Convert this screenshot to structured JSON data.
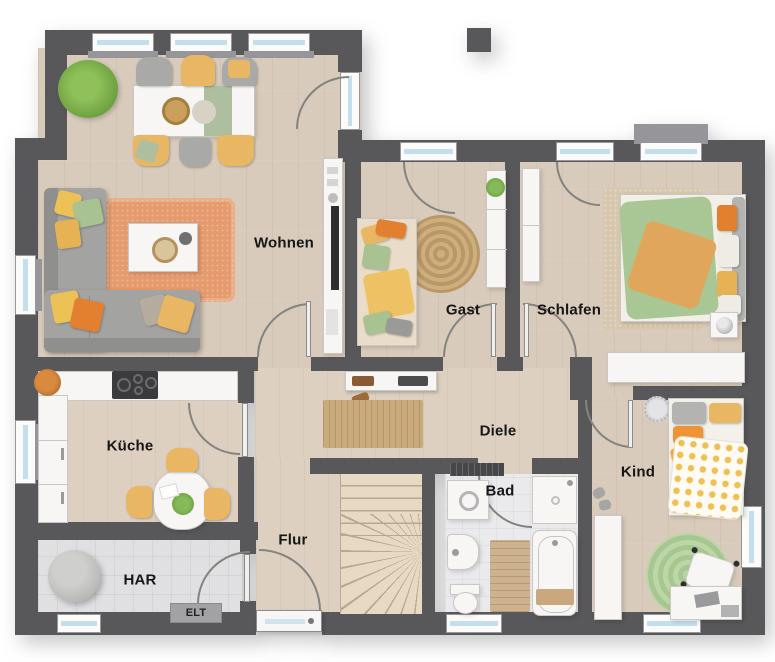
{
  "rooms": {
    "wohnen": "Wohnen",
    "gast": "Gast",
    "schlafen": "Schlafen",
    "kueche": "Küche",
    "diele": "Diele",
    "kind": "Kind",
    "bad": "Bad",
    "flur": "Flur",
    "har": "HAR",
    "elt": "ELT"
  },
  "colors": {
    "wall": "#58585a",
    "wood_floor": "#d9cbbb",
    "tile_floor": "#e0e0e2",
    "accent_orange": "#e8965a",
    "accent_yellow": "#eab95f",
    "accent_green": "#a9c291",
    "window_glass": "#c3dfef",
    "rug_orange": "#e69b6e",
    "rug_jute": "#c9aa7c"
  }
}
